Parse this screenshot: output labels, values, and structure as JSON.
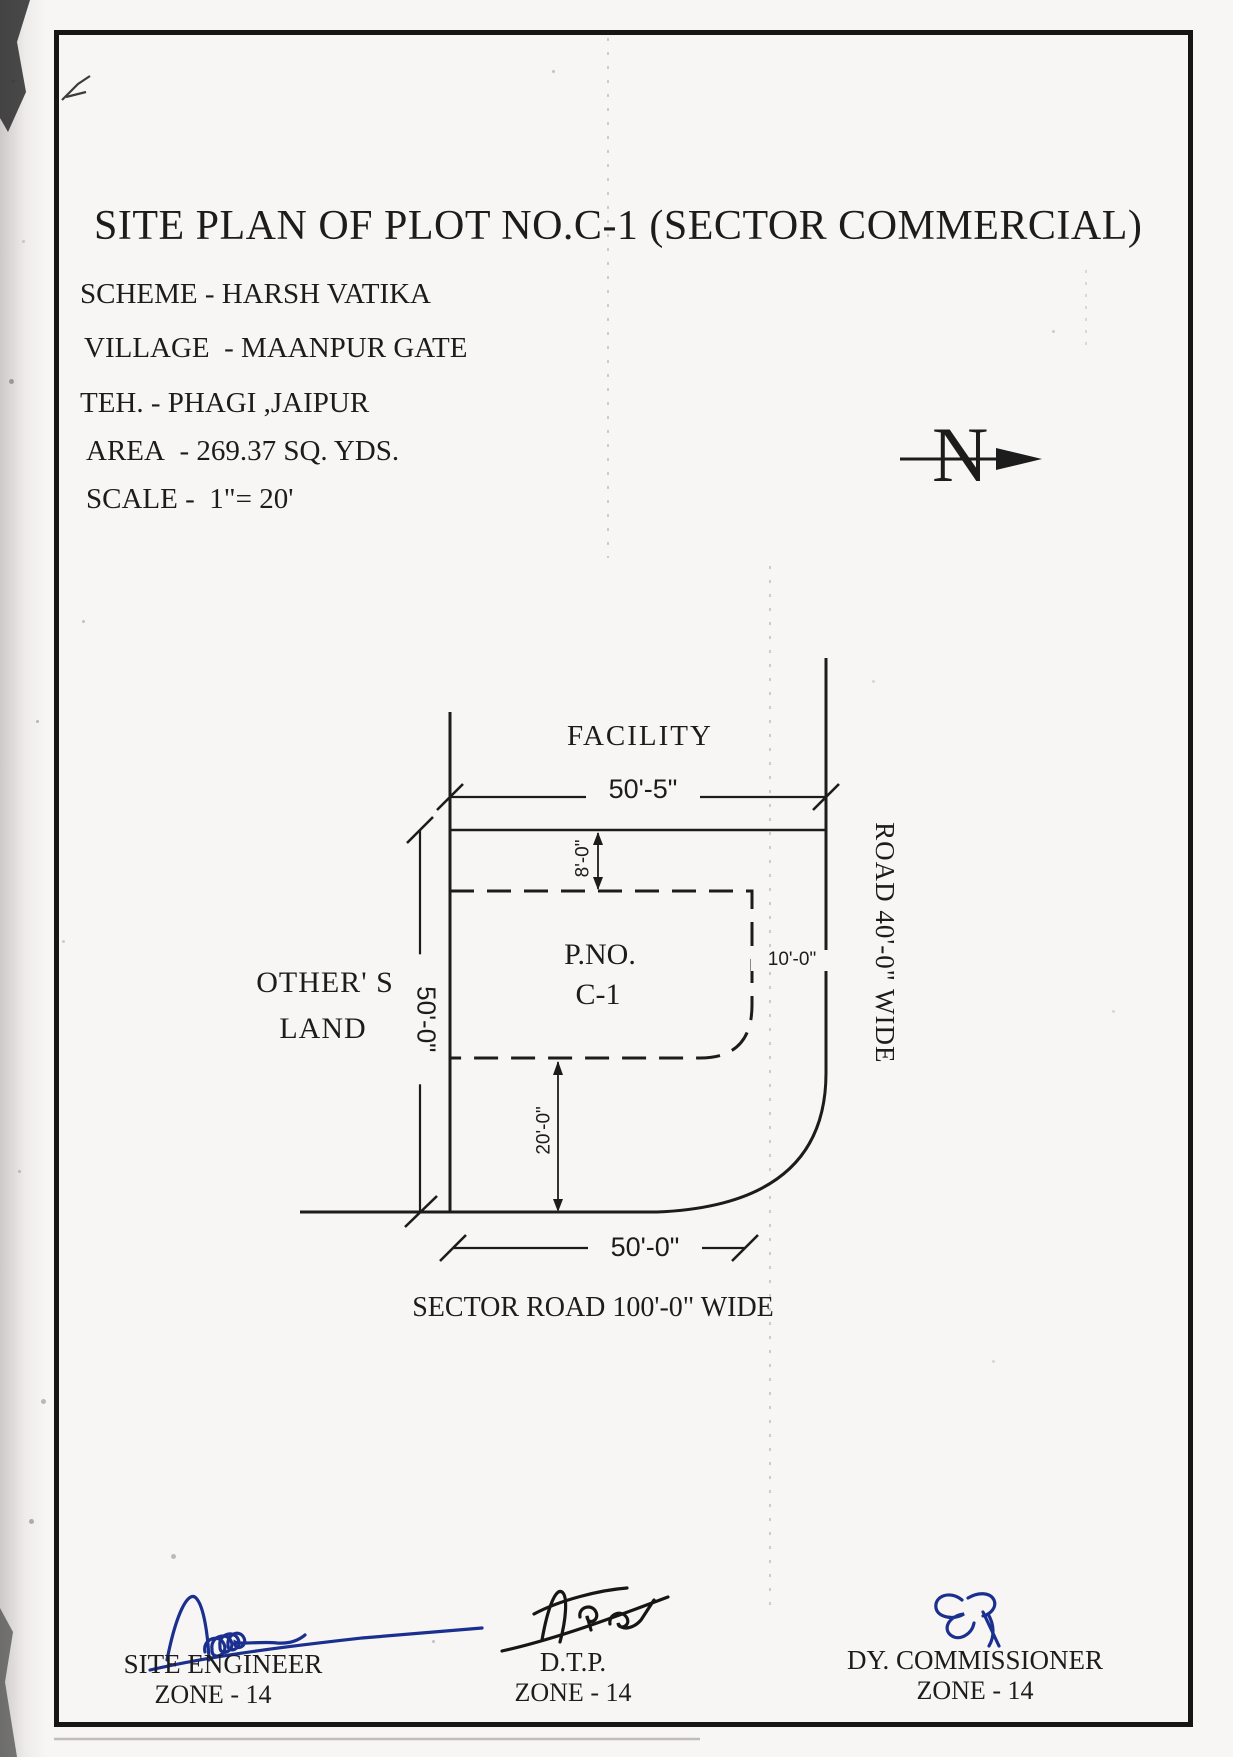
{
  "document": {
    "title": "SITE PLAN OF PLOT NO.C-1 (SECTOR COMMERCIAL)",
    "scheme_line": "SCHEME - HARSH VATIKA",
    "village_line": "VILLAGE  - MAANPUR GATE",
    "tehsil_line": "TEH. - PHAGI ,JAIPUR",
    "area_line": "AREA  - 269.37 SQ. YDS.",
    "scale_line": "SCALE -  1\"= 20'"
  },
  "north_arrow": {
    "label": "N"
  },
  "plan": {
    "facility_label": "FACILITY",
    "plot_number_line1": "P.NO.",
    "plot_number_line2": "C-1",
    "adjacent_land_line1": "OTHER' S",
    "adjacent_land_line2": "LAND",
    "right_road_label": "ROAD 40'-0\" WIDE",
    "bottom_road_label": "SECTOR ROAD 100'-0\" WIDE",
    "dim_top_width": "50'-5\"",
    "dim_left_height": "50'-0\"",
    "dim_bottom_width": "50'-0\"",
    "dim_setback_top": "8'-0\"",
    "dim_setback_right": "10'-0\"",
    "dim_setback_bottom": "20'-0\""
  },
  "signatures": [
    {
      "title": "SITE ENGINEER",
      "zone": "ZONE - 14"
    },
    {
      "title": "D.T.P.",
      "zone": "ZONE - 14"
    },
    {
      "title": "DY. COMMISSIONER",
      "zone": "ZONE - 14"
    }
  ],
  "colors": {
    "ink": "#1c1c1c",
    "signature_blue": "#1b2f8f",
    "paper": "#f8f6f5"
  }
}
